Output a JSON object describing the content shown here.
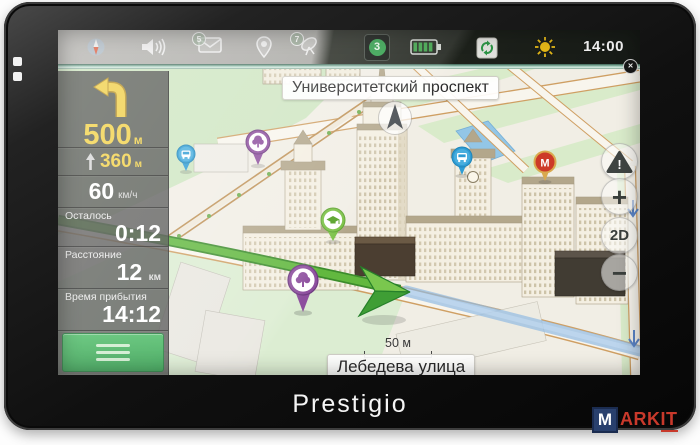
{
  "device": {
    "brand_label": "Prestigio"
  },
  "watermark": {
    "m": "M",
    "ark": "ARK",
    "it": "IT"
  },
  "statusbar": {
    "time": "14:00",
    "messages_count": "5",
    "satellites_count": "7",
    "traffic_level": "3",
    "icons": [
      "compass",
      "volume",
      "messages",
      "location",
      "satellites",
      "traffic",
      "battery",
      "sync",
      "day-night"
    ]
  },
  "sidebar": {
    "maneuver_distance": "500",
    "maneuver_unit": "м",
    "after_distance": "360",
    "after_unit": "м",
    "speed_value": "60",
    "speed_unit": "км/ч",
    "remaining": {
      "label": "Осталось",
      "value": "0:12"
    },
    "distance": {
      "label": "Расстояние",
      "value": "12",
      "unit": "км"
    },
    "arrival": {
      "label": "Время прибытия",
      "value": "14:12"
    }
  },
  "map": {
    "street_top": "Университетский проспект",
    "street_bottom": "Лебедева улица",
    "scale_label": "50 м",
    "metro_pin_label": "M",
    "buttons": {
      "zoom_in_label": "+",
      "zoom_out_label": "−",
      "mode_label": "2D"
    },
    "pois": [
      "park-tree",
      "park-tree-large",
      "bus-stop",
      "bus-stop-2",
      "metro-station",
      "university"
    ],
    "colors": {
      "route_traveled": "#62b83f",
      "route_ahead": "#9abce3",
      "accent_green": "#3fae5c",
      "highlight_yellow": "#f2d24a",
      "park_green": "#cfe6c2"
    }
  }
}
